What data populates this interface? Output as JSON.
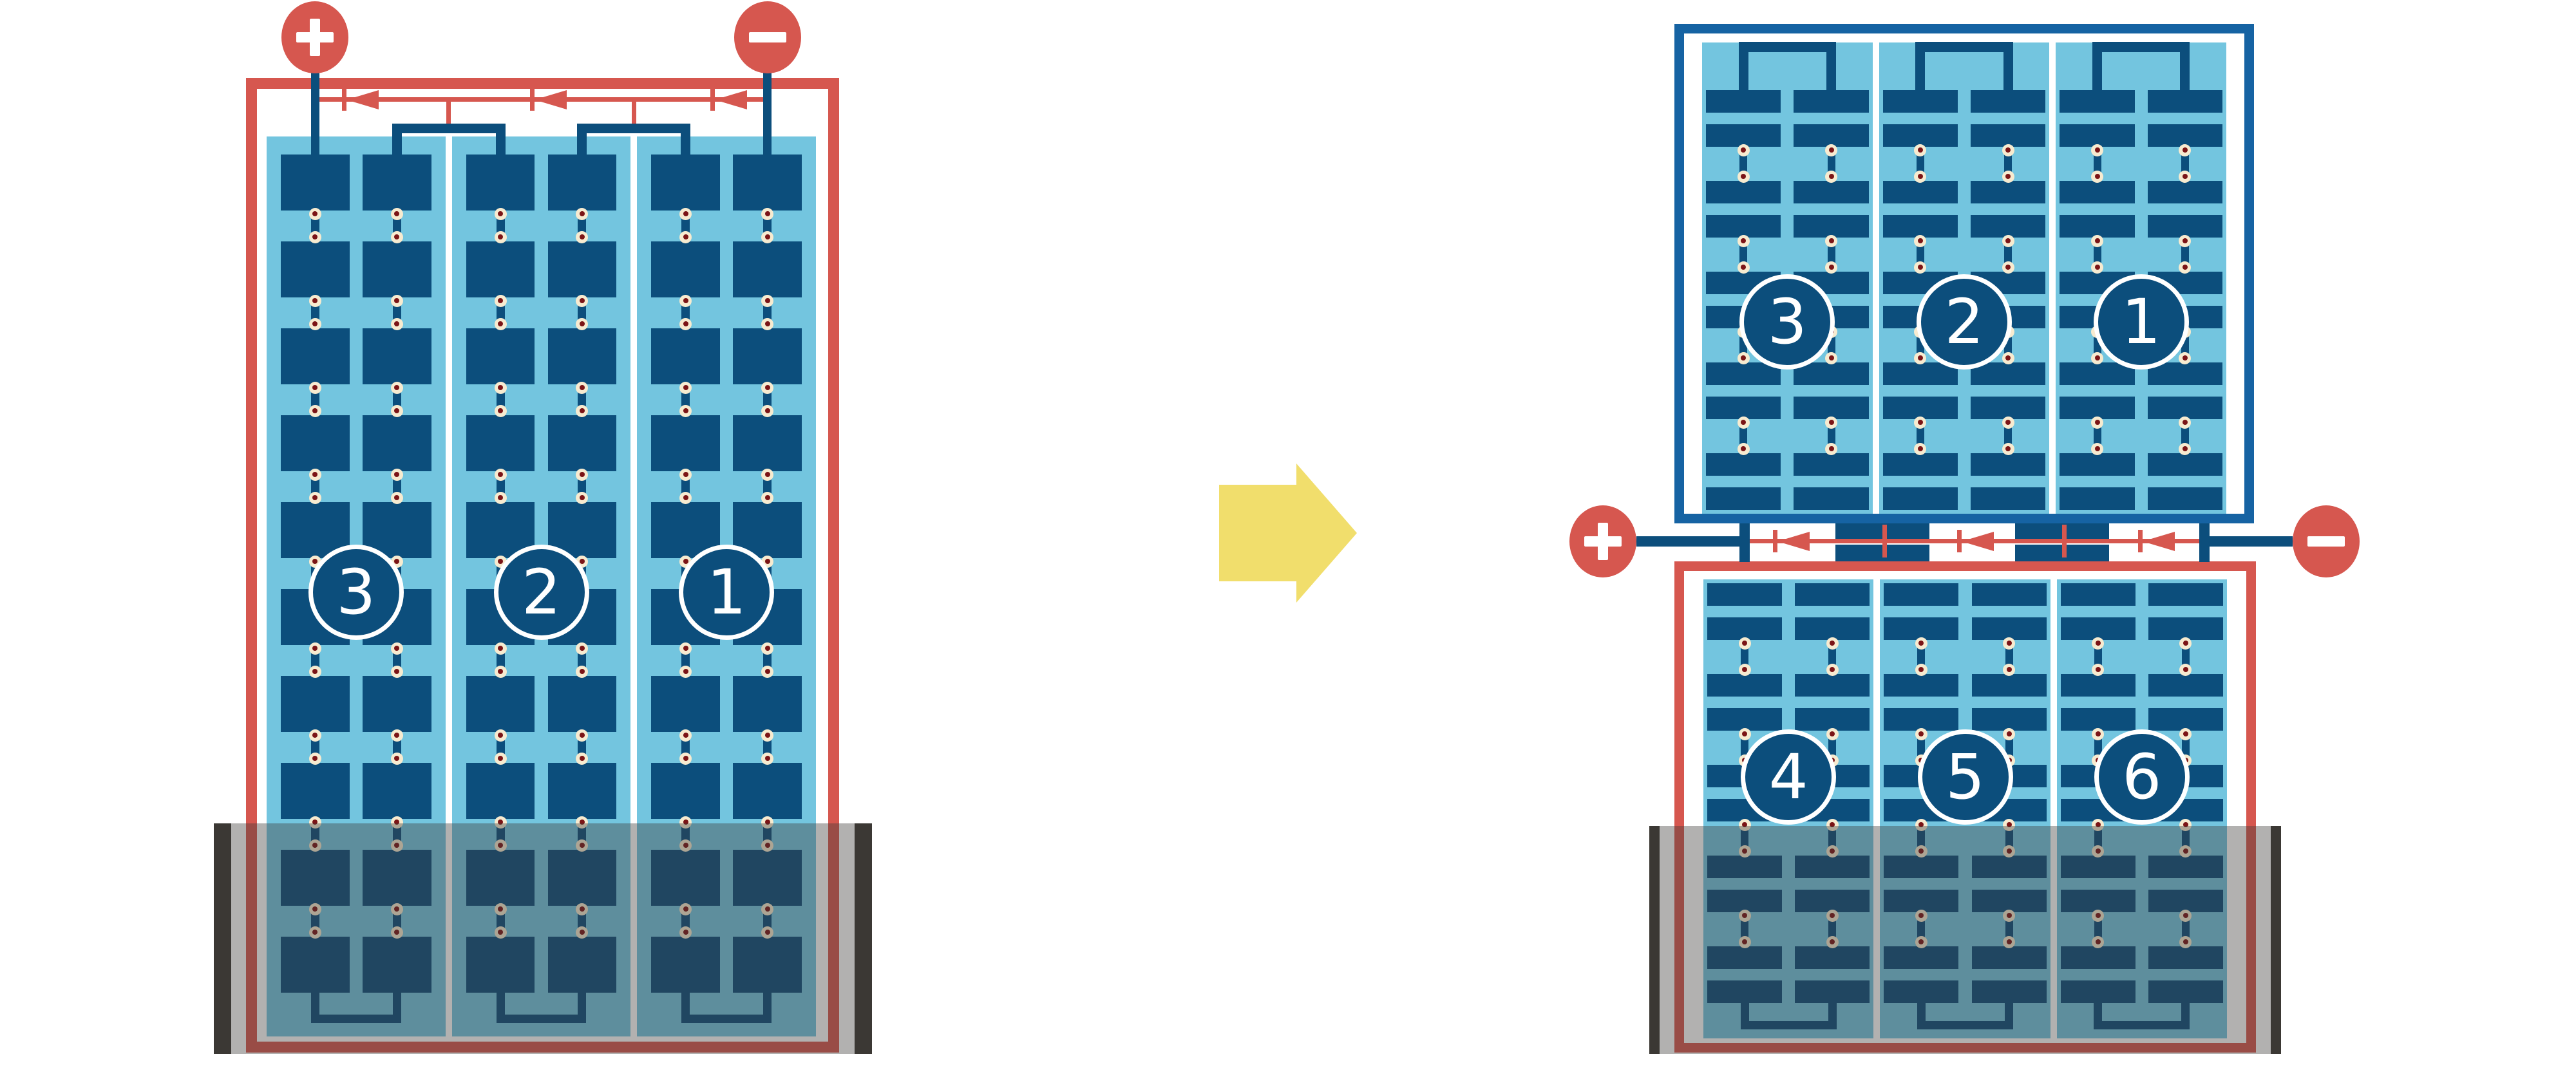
{
  "colors": {
    "background": "#ffffff",
    "white": "#ffffff",
    "red": "#D6574F",
    "wire": "#0C4E7C",
    "frame_blue": "#1663A3",
    "light_blue": "#73C5DF",
    "cream": "#F7EBD0",
    "dot_core": "#7B1416",
    "overlay": "rgba(62,60,58,0.40)",
    "shade_bar": "#3B3834",
    "yellow": "#F1DE6C"
  },
  "before": {
    "plus_label": "+",
    "minus_label": "−",
    "string_markers": [
      "3",
      "2",
      "1"
    ]
  },
  "after": {
    "plus_label": "+",
    "minus_label": "−",
    "top_string_markers": [
      "3",
      "2",
      "1"
    ],
    "bottom_string_markers": [
      "4",
      "5",
      "6"
    ]
  },
  "structure": {
    "strings_per_module": 3,
    "cell_columns_per_string": 2,
    "cell_rows_before": 10,
    "half_cell_pairs_after": 5,
    "bypass_diodes_per_module": 3
  }
}
